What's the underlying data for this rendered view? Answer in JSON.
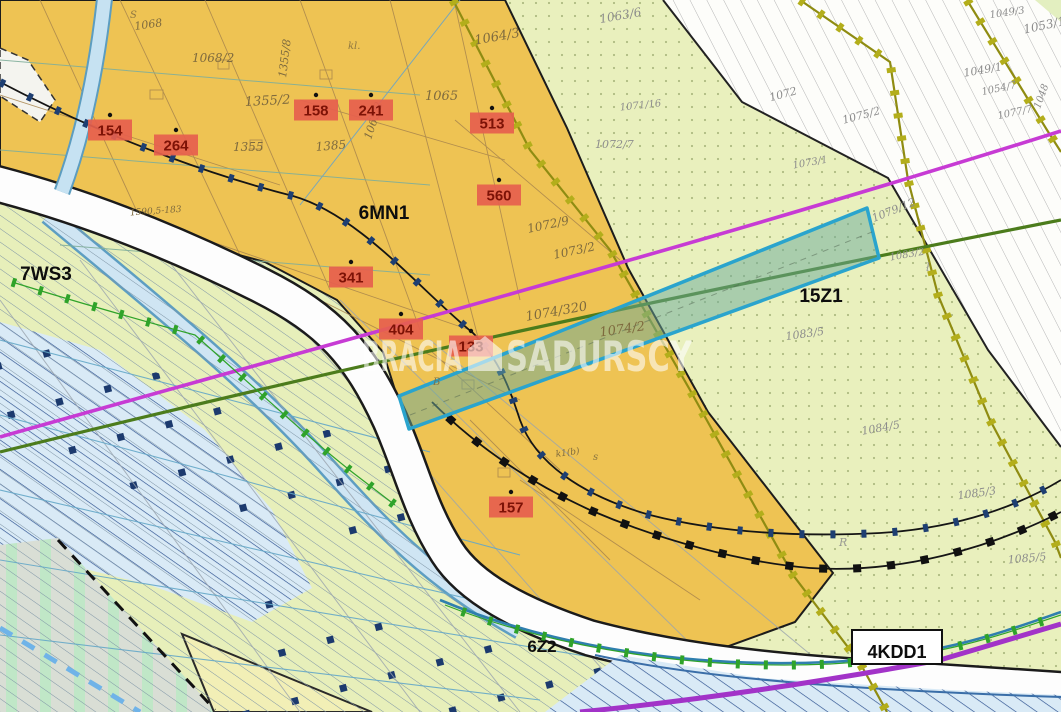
{
  "app": {
    "type": "zoning-plan-map",
    "watermark_brand": "BRACIA SADURSCY"
  },
  "watermark": {
    "left": "BRACIA",
    "right": "SADURSCY"
  },
  "zones": [
    {
      "label": "6MN1",
      "kind": "residential"
    },
    {
      "label": "7WS3",
      "kind": "water-greenery"
    },
    {
      "label": "15Z1",
      "kind": "greenery"
    },
    {
      "label": "6Z2",
      "kind": "greenery"
    },
    {
      "label": "4KDD1",
      "kind": "road"
    }
  ],
  "markers": [
    {
      "num": "154"
    },
    {
      "num": "264"
    },
    {
      "num": "158"
    },
    {
      "num": "241"
    },
    {
      "num": "513"
    },
    {
      "num": "560"
    },
    {
      "num": "341"
    },
    {
      "num": "404"
    },
    {
      "num": "133"
    },
    {
      "num": "157"
    }
  ],
  "parcels": [
    {
      "n": "1068"
    },
    {
      "n": "1068/2"
    },
    {
      "n": "1355/2"
    },
    {
      "n": "1355"
    },
    {
      "n": "1385"
    },
    {
      "n": "1065/2"
    },
    {
      "n": "1355/8"
    },
    {
      "n": "1590,5-183"
    },
    {
      "n": "1063/6"
    },
    {
      "n": "1064/3"
    },
    {
      "n": "1065"
    },
    {
      "n": "1071/16"
    },
    {
      "n": "1072/7"
    },
    {
      "n": "1072"
    },
    {
      "n": "1075/2"
    },
    {
      "n": "1073/1"
    },
    {
      "n": "1072/9"
    },
    {
      "n": "1073/2"
    },
    {
      "n": "1074/320"
    },
    {
      "n": "1074/2"
    },
    {
      "n": "1079/12"
    },
    {
      "n": "1083/2"
    },
    {
      "n": "1083/5"
    },
    {
      "n": "1084/5"
    },
    {
      "n": "1085/3"
    },
    {
      "n": "1085/5"
    },
    {
      "n": "1049/3"
    },
    {
      "n": "1053/1"
    },
    {
      "n": "1049/1"
    },
    {
      "n": "1054/7"
    },
    {
      "n": "1077/7"
    },
    {
      "n": "1048"
    },
    {
      "n": "k1(b)"
    }
  ],
  "letters": [
    {
      "ch": "S"
    },
    {
      "ch": "kl."
    },
    {
      "ch": "B"
    },
    {
      "ch": "R"
    },
    {
      "ch": "ł"
    },
    {
      "ch": "s"
    }
  ],
  "colors": {
    "residential_fill": "#eec353",
    "greenery_fill": "#e9f0bd",
    "water_fill": "#d9eaf6",
    "selection_stroke": "#2aa4cd",
    "boundary_olive": "#a8a416",
    "line_magenta": "#c73bd4",
    "line_purple": "#a233c8",
    "line_darkgreen": "#4c7c1c",
    "marker_bg": "#e6604e",
    "chain_navy": "#1c3a6e"
  }
}
